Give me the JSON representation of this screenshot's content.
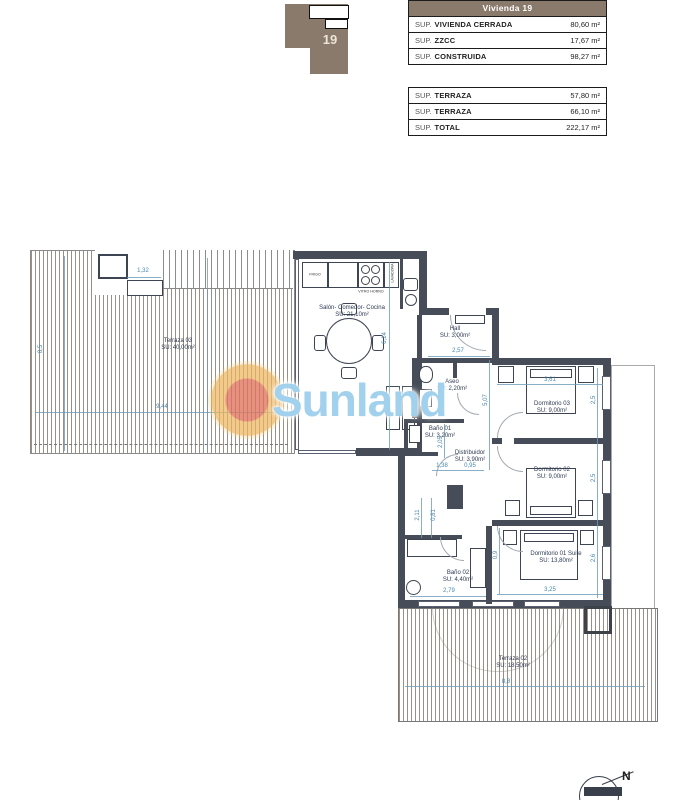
{
  "key_plan": {
    "unit": "19"
  },
  "tables": {
    "header": "Vivienda 19",
    "main_rows": [
      {
        "prefix": "SUP.",
        "label": "VIVIENDA CERRADA",
        "value": "80,60 m²"
      },
      {
        "prefix": "SUP.",
        "label": "ZZCC",
        "value": "17,67 m²"
      },
      {
        "prefix": "SUP.",
        "label": "CONSTRUIDA",
        "value": "98,27 m²"
      }
    ],
    "terrace_rows": [
      {
        "prefix": "SUP.",
        "label": "TERRAZA",
        "value": "57,80 m²"
      },
      {
        "prefix": "SUP.",
        "label": "TERRAZA",
        "value": "66,10 m²"
      },
      {
        "prefix": "SUP.",
        "label": "TOTAL",
        "value": "222,17 m²"
      }
    ]
  },
  "rooms": {
    "salon": {
      "name": "Salón- Comedor- Cocina",
      "area": "SU: 21,10m²"
    },
    "hall": {
      "name": "Hall",
      "area": "SU: 3,00m²"
    },
    "aseo": {
      "name": "Aseo",
      "area": "SU: 2,20m²"
    },
    "bano01": {
      "name": "Baño 01",
      "area": "SU: 3,20m²"
    },
    "distribuidor": {
      "name": "Distribuidor",
      "area": "SU: 3,90m²"
    },
    "dorm03": {
      "name": "Dormitorio 03",
      "area": "SU: 9,00m²"
    },
    "dorm02": {
      "name": "Dormitorio 02",
      "area": "SU: 9,00m²"
    },
    "dorm01": {
      "name": "Dormitorio 01 Suite",
      "area": "SU: 13,80m²"
    },
    "bano02": {
      "name": "Baño 02",
      "area": "SU: 4,40m²"
    },
    "terraza03": {
      "name": "Terraza 03",
      "area": "SU: 40,00m²"
    },
    "terraza02": {
      "name": "Terraza 02",
      "area": "SU: 18,50m²"
    }
  },
  "kitchen_labels": {
    "fridge": "FRIGO",
    "hob": "VITRO HORNO",
    "washer": "LAVADORA"
  },
  "dims": [
    "1,32",
    "6,14",
    "2,57",
    "5,07",
    "3,61",
    "2,5",
    "2,5",
    "0,9",
    "2,6",
    "3,25",
    "1,38",
    "0,95",
    "2,05",
    "2,11",
    "0,81",
    "2,79",
    "9,44",
    "8,5",
    "8,8"
  ],
  "watermark": {
    "text": "Sunland"
  },
  "compass": {
    "label": "N"
  },
  "colors": {
    "wall": "#474d58",
    "dim": "#4688ad",
    "hatch": "#9a8f80",
    "table_header_bg": "#8a7a6b"
  }
}
